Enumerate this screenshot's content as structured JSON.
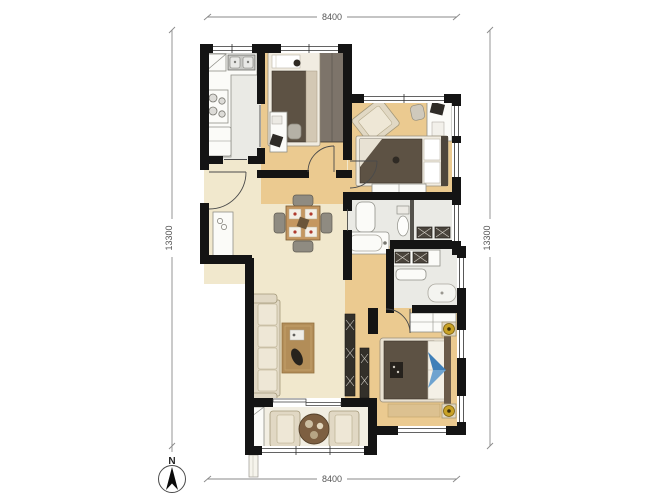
{
  "title": "apartment-floor-plan",
  "dimensions": {
    "top": "8400",
    "bottom": "8400",
    "left": "13300",
    "right": "13300"
  },
  "compass": {
    "north_label": "N"
  },
  "palette": {
    "wall": "#141414",
    "floor_wood": "#ebca90",
    "floor_cream": "#f1e8cd",
    "floor_tile": "#eaeae5",
    "floor_balcony": "#f2eee2",
    "furniture_dark": "#5d5244",
    "accent_blue": "#3f7fb8",
    "accent_gold": "#c9a227",
    "accent_red": "#b03a2e",
    "dim_line": "#8a8a8a",
    "dim_text": "#555555"
  }
}
